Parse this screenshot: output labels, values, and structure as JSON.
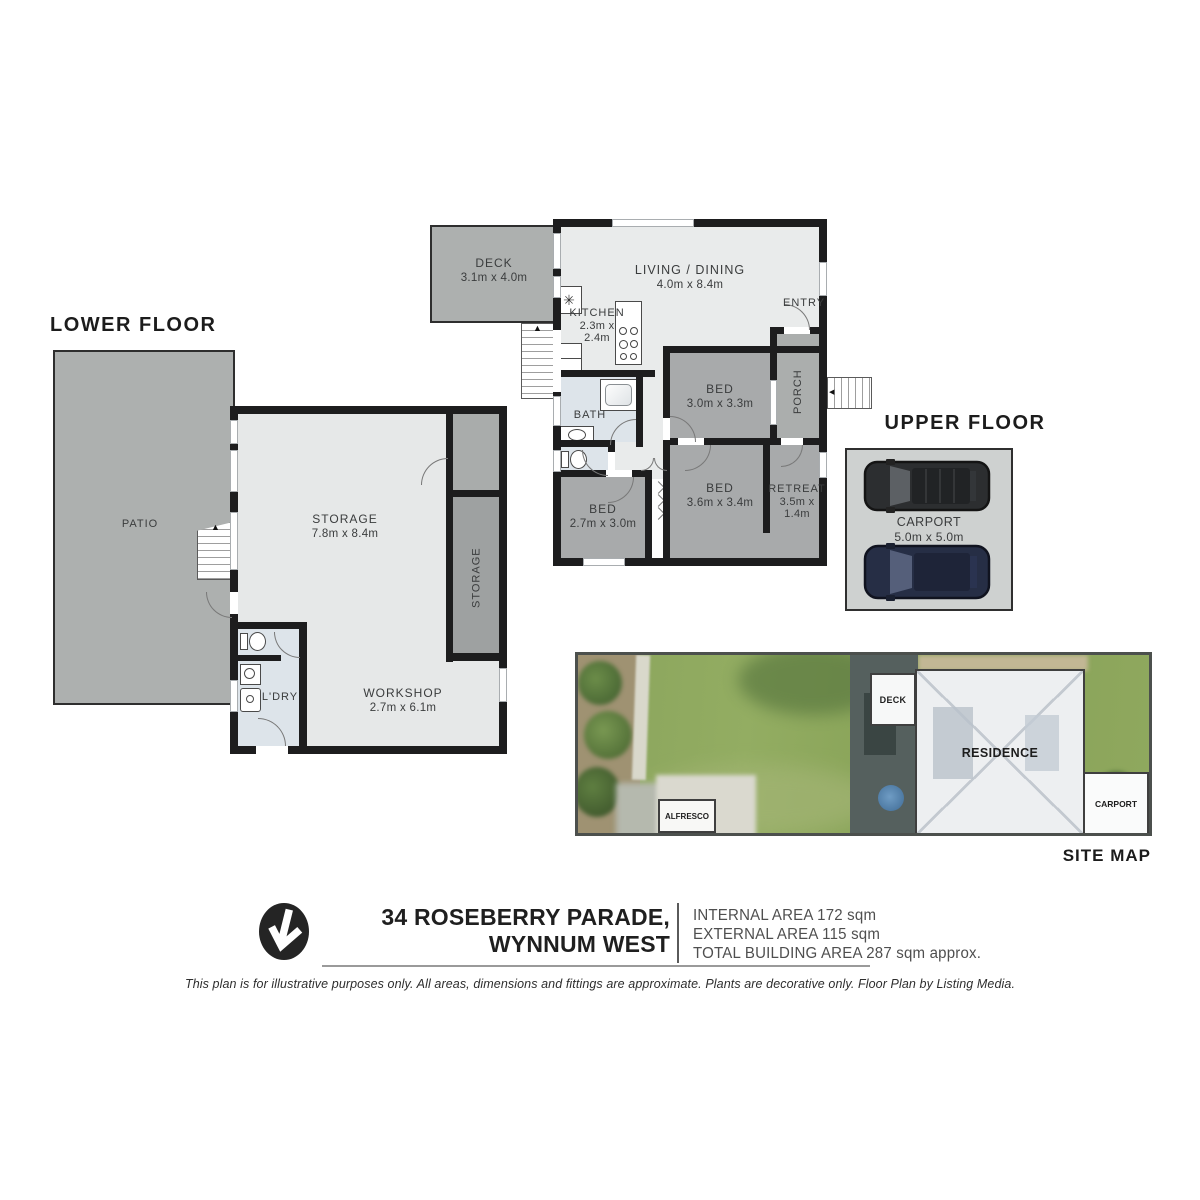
{
  "lower_floor": {
    "title": "LOWER FLOOR",
    "patio": {
      "name": "PATIO"
    },
    "storage": {
      "name": "STORAGE",
      "dims": "7.8m x 8.4m"
    },
    "storage_side": {
      "name": "STORAGE"
    },
    "workshop": {
      "name": "WORKSHOP",
      "dims": "2.7m x 6.1m"
    },
    "laundry": {
      "name": "L'DRY"
    }
  },
  "upper_floor": {
    "title": "UPPER FLOOR",
    "deck": {
      "name": "DECK",
      "dims": "3.1m x 4.0m"
    },
    "living_dining": {
      "name": "LIVING / DINING",
      "dims": "4.0m x 8.4m"
    },
    "kitchen": {
      "name": "KITCHEN",
      "dims_line1": "2.3m x",
      "dims_line2": "2.4m"
    },
    "entry": {
      "name": "ENTRY"
    },
    "porch": {
      "name": "PORCH"
    },
    "bath": {
      "name": "BATH"
    },
    "bed_front": {
      "name": "BED",
      "dims": "3.0m x 3.3m"
    },
    "bed_middle": {
      "name": "BED",
      "dims": "3.6m x 3.4m"
    },
    "bed_left": {
      "name": "BED",
      "dims": "2.7m x 3.0m"
    },
    "retreat": {
      "name": "RETREAT",
      "dims_line1": "3.5m x",
      "dims_line2": "1.4m"
    },
    "carport": {
      "name": "CARPORT",
      "dims": "5.0m x 5.0m"
    }
  },
  "site_map": {
    "title": "SITE MAP",
    "deck_label": "DECK",
    "residence_label": "RESIDENCE",
    "carport_label": "CARPORT",
    "alfresco_label": "ALFRESCO"
  },
  "footer": {
    "address_line1": "34 ROSEBERRY PARADE,",
    "address_line2": "WYNNUM WEST",
    "internal_area": "INTERNAL AREA 172 sqm",
    "external_area": "EXTERNAL AREA 115 sqm",
    "total_area": "TOTAL BUILDING AREA 287 sqm approx.",
    "disclaimer": "This plan is for illustrative purposes only. All areas, dimensions and fittings are approximate. Plants are decorative only. Floor Plan by Listing Media."
  },
  "colors": {
    "wall": "#1d1d1e",
    "outdoor_gray": "#adb0af",
    "room_gray": "#a8aaab",
    "interior_light": "#e7e9e9",
    "wet_blue": "#dde4ea",
    "carport_fill": "#ced1d0",
    "grass_green": "#8aa45c"
  }
}
